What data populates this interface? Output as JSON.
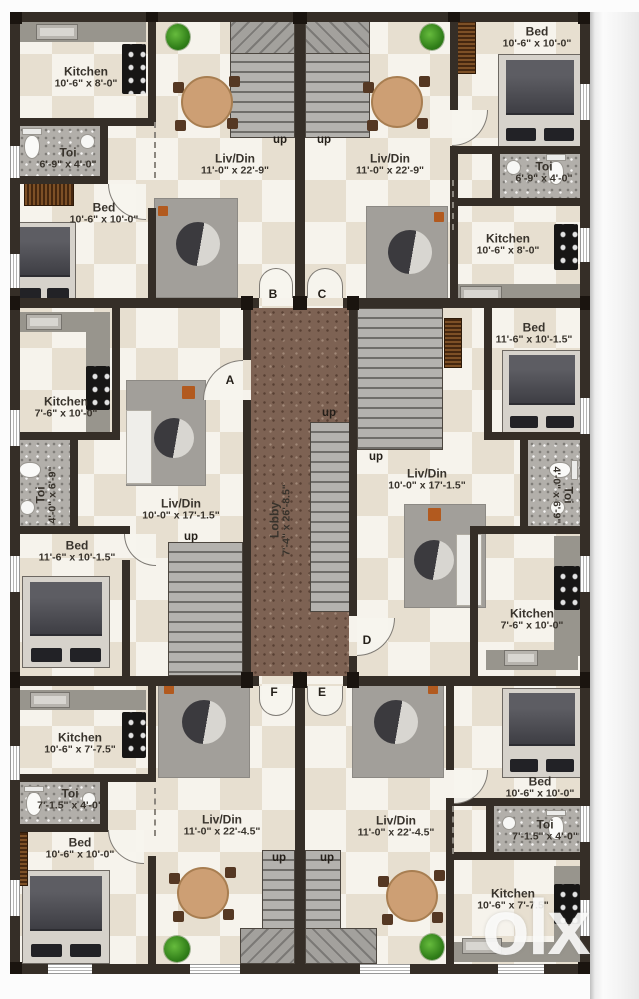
{
  "watermark": "olx",
  "labels": {
    "up": "up"
  },
  "doors": {
    "a": "A",
    "b": "B",
    "c": "C",
    "d": "D",
    "e": "E",
    "f": "F"
  },
  "lobby": {
    "name": "Lobby",
    "dims": "7'-4\" x 26'-8.5\""
  },
  "units": {
    "top_left": {
      "kitchen": {
        "name": "Kitchen",
        "dims": "10'-6\" x 8'-0\""
      },
      "toi": {
        "name": "Toi",
        "dims": "6'-9\" x 4'-0\""
      },
      "bed": {
        "name": "Bed",
        "dims": "10'-6\" x 10'-0\""
      },
      "liv": {
        "name": "Liv/Din",
        "dims": "11'-0\" x 22'-9\""
      }
    },
    "top_right": {
      "bed": {
        "name": "Bed",
        "dims": "10'-6\" x 10'-0\""
      },
      "toi": {
        "name": "Toi",
        "dims": "6'-9\" x 4'-0\""
      },
      "kitchen": {
        "name": "Kitchen",
        "dims": "10'-6\" x 8'-0\""
      },
      "liv": {
        "name": "Liv/Din",
        "dims": "11'-0\" x 22'-9\""
      }
    },
    "mid_left": {
      "kitchen": {
        "name": "Kitchen",
        "dims": "7'-6\" x 10'-0\""
      },
      "toi": {
        "name": "Toi",
        "dims": "4'-0\" x 6'-9\""
      },
      "bed": {
        "name": "Bed",
        "dims": "11'-6\" x 10'-1.5\""
      },
      "liv": {
        "name": "Liv/Din",
        "dims": "10'-0\" x 17'-1.5\""
      }
    },
    "mid_right": {
      "bed": {
        "name": "Bed",
        "dims": "11'-6\" x 10'-1.5\""
      },
      "toi": {
        "name": "Toi",
        "dims": "4'-0\" x 6'-9\""
      },
      "kitchen": {
        "name": "Kitchen",
        "dims": "7'-6\" x 10'-0\""
      },
      "liv": {
        "name": "Liv/Din",
        "dims": "10'-0\" x 17'-1.5\""
      }
    },
    "bottom_left": {
      "kitchen": {
        "name": "Kitchen",
        "dims": "10'-6\" x 7'-7.5\""
      },
      "toi": {
        "name": "Toi",
        "dims": "7'-1.5\" x 4'-0\""
      },
      "bed": {
        "name": "Bed",
        "dims": "10'-6\" x 10'-0\""
      },
      "liv": {
        "name": "Liv/Din",
        "dims": "11'-0\" x 22'-4.5\""
      }
    },
    "bottom_right": {
      "bed": {
        "name": "Bed",
        "dims": "10'-6\" x 10'-0\""
      },
      "toi": {
        "name": "Toi",
        "dims": "7'-1.5\" x 4'-0\""
      },
      "kitchen": {
        "name": "Kitchen",
        "dims": "10'-6\" x 7'-7.5\""
      },
      "liv": {
        "name": "Liv/Din",
        "dims": "11'-0\" x 22'-4.5\""
      }
    }
  },
  "colors": {
    "wall": "#352e27",
    "lobby_floor": "#7d6253",
    "floor_light": "#f6f3ec",
    "floor_dark": "#e7dfd0",
    "wood_accent": "#cd9f74",
    "plant_green": "#4aa42c"
  }
}
